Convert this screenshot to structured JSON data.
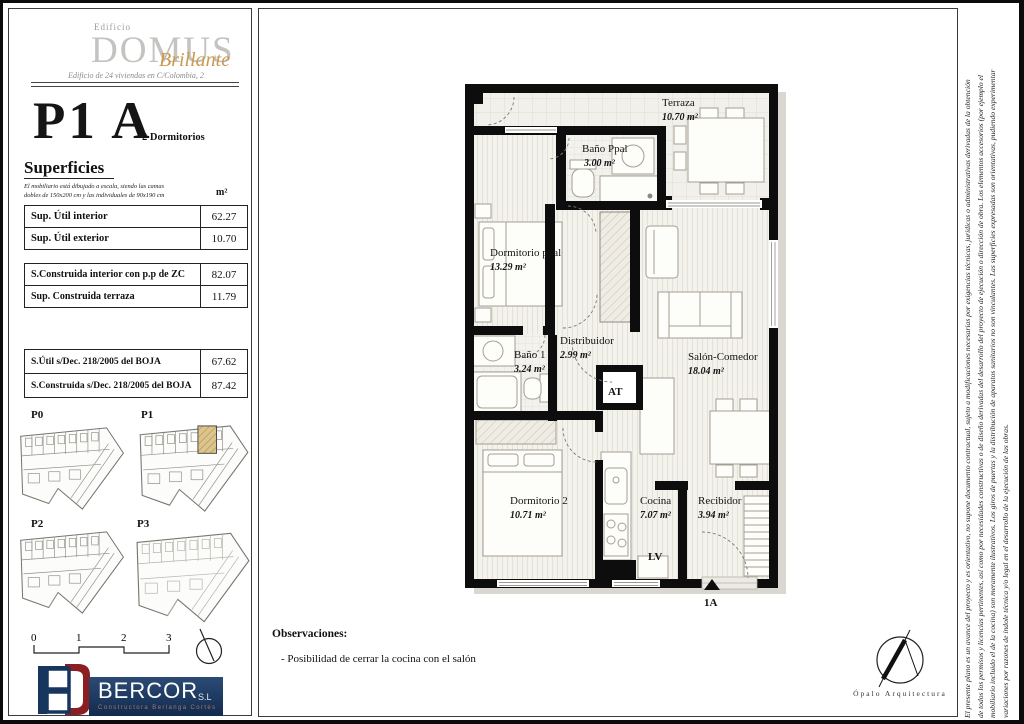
{
  "header": {
    "edificio": "Edificio",
    "title": "DOMUS",
    "subtitle_script": "Brillante",
    "tagline": "Edificio de 24 viviendas en C/Colombia, 2"
  },
  "unit": {
    "code": "P1 A",
    "type": "2 Dormitorios"
  },
  "superficies": {
    "heading": "Superficies",
    "note_line1": "El mobiliario está dibujado a escala, siendo las camas",
    "note_line2": "dobles de 150x200 cm y las individuales de 90x190 cm",
    "unit_header": "m²",
    "tables": [
      {
        "rows": [
          {
            "label": "Sup. Útil interior",
            "value": "62.27"
          },
          {
            "label": "Sup. Útil exterior",
            "value": "10.70"
          }
        ]
      },
      {
        "rows": [
          {
            "label": "S.Construida interior con p.p de ZC",
            "value": "82.07"
          },
          {
            "label": "Sup. Construida  terraza",
            "value": "11.79"
          }
        ]
      },
      {
        "rows": [
          {
            "label": "S.Útil s/Dec. 218/2005 del BOJA",
            "value": "67.62"
          },
          {
            "label": "S.Construida s/Dec. 218/2005 del BOJA",
            "value": "87.42"
          }
        ]
      }
    ]
  },
  "thumbnails": {
    "items": [
      {
        "label": "P0"
      },
      {
        "label": "P1",
        "highlighted": true
      },
      {
        "label": "P2"
      },
      {
        "label": "P3"
      }
    ]
  },
  "scalebar": {
    "ticks": [
      "0",
      "1",
      "2",
      "3"
    ]
  },
  "bercor": {
    "name": "BERCOR",
    "suffix": "S.L",
    "tagline": "Constructora Berlanga Cortés"
  },
  "plan": {
    "rooms": [
      {
        "name": "Terraza",
        "area": "10.70 m²"
      },
      {
        "name": "Baño Ppal",
        "area": "3.00 m²"
      },
      {
        "name": "Dormitorio ppal",
        "area": "13.29 m²"
      },
      {
        "name": "Distribuidor",
        "area": "2.99 m²"
      },
      {
        "name": "Baño 1",
        "area": "3.24 m²"
      },
      {
        "name": "Salón-Comedor",
        "area": "18.04 m²"
      },
      {
        "name": "Dormitorio 2",
        "area": "10.71 m²"
      },
      {
        "name": "Cocina",
        "area": "7.07 m²"
      },
      {
        "name": "Recibidor",
        "area": "3.94 m²"
      }
    ],
    "shaft_label": "AT",
    "appliance_label": "LV",
    "entrance_label": "1A"
  },
  "observaciones": {
    "heading": "Observaciones:",
    "item1": "- Posibilidad de cerrar la cocina con el salón"
  },
  "opalo": {
    "name": "Ópalo Arquitectura"
  },
  "disclaimer": {
    "line1": "El presente plano es un avance del proyecto y es orientativo, no supone documento contractual, sujeto a modificaciones necesarias por exigencias técnicas, jurídicas o administrativas derivadas de la obtención",
    "line2": "de todos los permisos y licencias pertinentes, así como por necesidades constructivas o de diseño derivadas del desarrollo del proyecto de ejecución o dirección de obra. Los elementos accesorios (por ejemplo el",
    "line3": "mobiliario incluido el de la cocina) son meramente ilustrativos. Los giros de puertas y la distribución de aparatos sanitarios no son vinculantes. Las superficies expresadas son orientativas, pudiendo experimentar",
    "line4": "variaciones por razones de índole técnica y/o legal en el desarrollo de la ejecución de las obras."
  },
  "colors": {
    "accent_gold": "#c99a4e",
    "brand_navy": "#17365d",
    "brand_red": "#8c1d22",
    "highlight_tan": "#dcc48e"
  }
}
